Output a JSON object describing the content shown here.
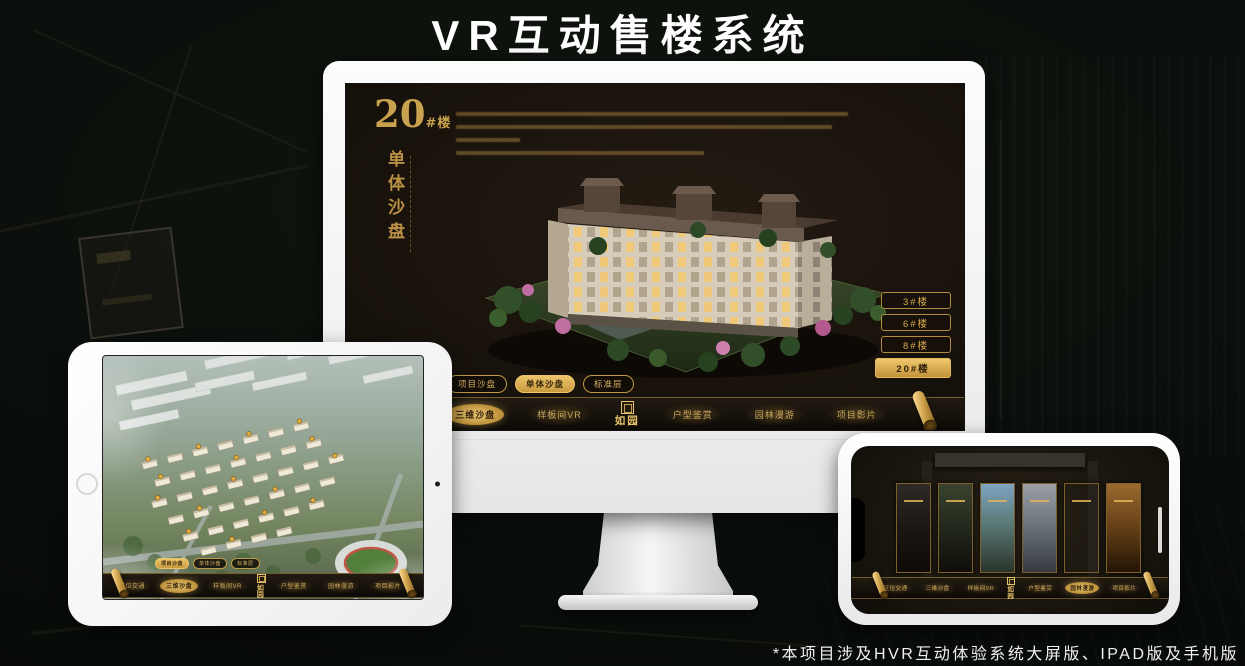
{
  "page": {
    "title": "VR互动售楼系统",
    "footnote": "*本项目涉及HVR互动体验系统大屏版、IPAD版及手机版"
  },
  "colors": {
    "gold": "#c9a24f",
    "gold_bright": "#ecc46d",
    "screen_bg": "#17110b",
    "stage_bg": "#0a0e0b",
    "device_bezel": "#f2f2f2"
  },
  "hero": {
    "block_no": "20",
    "block_unit": "#楼",
    "block_name": "单体沙盘"
  },
  "floor_buttons": [
    {
      "label": "3#楼",
      "active": false
    },
    {
      "label": "6#楼",
      "active": false
    },
    {
      "label": "8#楼",
      "active": false
    },
    {
      "label": "20#楼",
      "active": true
    }
  ],
  "sub_tabs": [
    {
      "label": "项目沙盘"
    },
    {
      "label": "单体沙盘"
    },
    {
      "label": "标准层"
    }
  ],
  "nav": {
    "items": [
      "区位交通",
      "三维沙盘",
      "样板间VR",
      "户型鉴赏",
      "园林漫游",
      "项目影片"
    ],
    "logo": "如园"
  },
  "monitor": {
    "active_sub_tab": "单体沙盘",
    "active_nav_item": "三维沙盘"
  },
  "ipad": {
    "active_sub_tab": "项目沙盘",
    "active_nav_item": "三维沙盘"
  },
  "phone": {
    "active_nav_item": "园林漫游",
    "gallery_panel_count": 6
  }
}
